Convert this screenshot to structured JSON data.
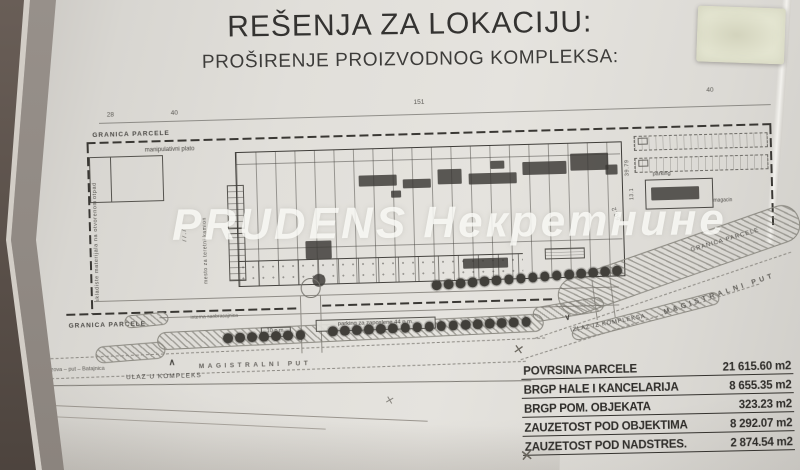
{
  "title": {
    "line1": "REŠENJA ZA LOKACIJU:",
    "line2": "PROŠIRENJE PROIZVODNOG KOMPLEKSA:"
  },
  "watermark": "PRUDENS Некретнине",
  "plan": {
    "labels": {
      "granica_top": "GRANICA PARCELE",
      "granica_bottom": "GRANICA PARCELE",
      "granica_right": "GRANICA PARCELE",
      "manipulativni_plato": "manipulativni plato",
      "otpad": "otpad",
      "skladiste": "skladiste materijala na otvorenom",
      "mesto_kamion": "mesto za teretni kamion",
      "parking_small": "parking",
      "magacin": "magacin",
      "parking_44": "parking za zaposlene   44 p.m.",
      "parking_10": "10 p.m.",
      "interna": "interna saobracajnica",
      "magistralni_left": "MAGISTRALNI PUT",
      "magistralni_right": "MAGISTRALNI PUT",
      "ulaz": "ULAZ U KOMPLEKS",
      "izlaz": "IZLAZ IZ KOMPLEKSA",
      "pazova": "Pazova  –  put  –  Batajnica"
    },
    "dims": {
      "d28": "28",
      "d40_left": "40",
      "d151": "151",
      "d40_right": "40",
      "d777": "77.7",
      "d3979": "39.79",
      "d131": "13.1",
      "d602": "60.2"
    },
    "trees": {
      "row_road": 16,
      "row_left": 7,
      "row_right": 17
    }
  },
  "areas_table": {
    "rows": [
      {
        "label": "POVRSINA PARCELE",
        "value": "21 615.60 m2"
      },
      {
        "label": "BRGP HALE I KANCELARIJA",
        "value": "8 655.35 m2"
      },
      {
        "label": "BRGP POM. OBJEKATA",
        "value": "323.23 m2"
      },
      {
        "label": "ZAUZETOST POD OBJEKTIMA",
        "value": "8 292.07 m2"
      },
      {
        "label": "ZAUZETOST POD NADSTRES.",
        "value": "2 874.54 m2"
      }
    ]
  },
  "icons": {
    "arrow_up": "∧",
    "arrow_down": "∨",
    "x_mark": "✕"
  },
  "colors": {
    "paper": "#dedcd7",
    "ink": "#3c3a36",
    "hatch": "#6e6c64",
    "tree": "#413f3a",
    "sticky": "#e4e5d1"
  }
}
